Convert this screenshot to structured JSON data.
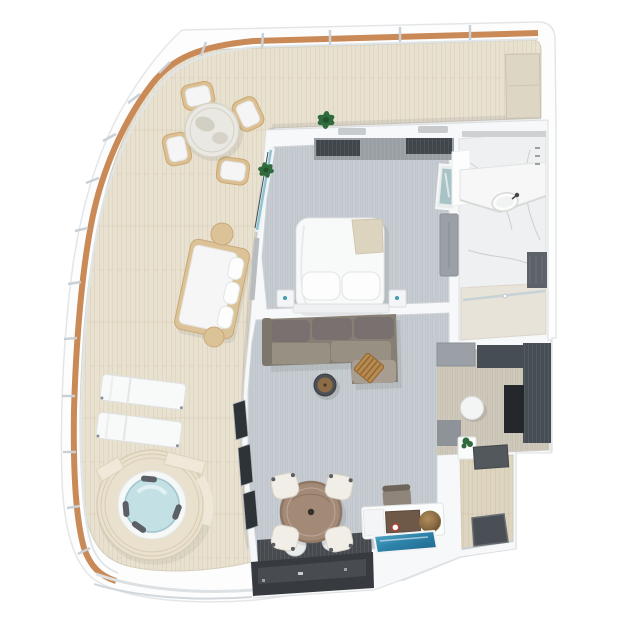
{
  "scene": {
    "kind": "3d-floorplan-top-down-render",
    "subject": "suite with wraparound balcony",
    "palette": {
      "hull_white": "#fdfdfe",
      "wall_white": "#f7f8f9",
      "deck": "#e9e1cf",
      "deck_edge": "#d8d0bc",
      "railing_wood": "#c98a57",
      "carpet": "#c6ccd1",
      "bath_marble": "#eef0f1",
      "shower_marble": "#e8e3d9",
      "dressing_carpet": "#cfc9bc",
      "entry_wood": "#ded5c1",
      "wardrobe_dark": "#474d54",
      "media_dark": "#373b40",
      "sofa_taupe": "#877f74",
      "table_wood": "#a38a77",
      "chair_cream": "#f1eee7",
      "frame_tan": "#dcc093",
      "water_blue": "#c3e1e5",
      "glass_blue": "#2f84ab",
      "bronze": "#8c6c46",
      "plant_green": "#2f6b3c",
      "glass_teal": "#8fc5d3"
    },
    "rooms": [
      {
        "name": "balcony-terrace",
        "furniture": [
          "outdoor-dining-table",
          "outdoor-chairs-x4",
          "potted-plants-x2",
          "daybed",
          "side-stools-x2",
          "sun-loungers-x2",
          "hot-tub",
          "storage-cabinet"
        ]
      },
      {
        "name": "bedroom",
        "furniture": [
          "double-bed",
          "pillows-x2",
          "nightstands-x2",
          "wardrobe-wall",
          "artwork",
          "dresser"
        ]
      },
      {
        "name": "bathroom",
        "furniture": [
          "vanity-sink",
          "shower",
          "storage-niche"
        ]
      },
      {
        "name": "living-room",
        "furniture": [
          "l-shaped-sofa",
          "coffee-table",
          "slatted-side-table",
          "media-wall"
        ]
      },
      {
        "name": "dining-area",
        "furniture": [
          "round-dining-table",
          "dining-chairs-x4",
          "bar-credenza",
          "desk-chair",
          "blue-glass-panel"
        ]
      },
      {
        "name": "dressing-area",
        "furniture": [
          "wardrobes",
          "pouf"
        ]
      },
      {
        "name": "entry-hall",
        "furniture": [
          "console-plant",
          "desk",
          "door-mat"
        ]
      }
    ]
  }
}
